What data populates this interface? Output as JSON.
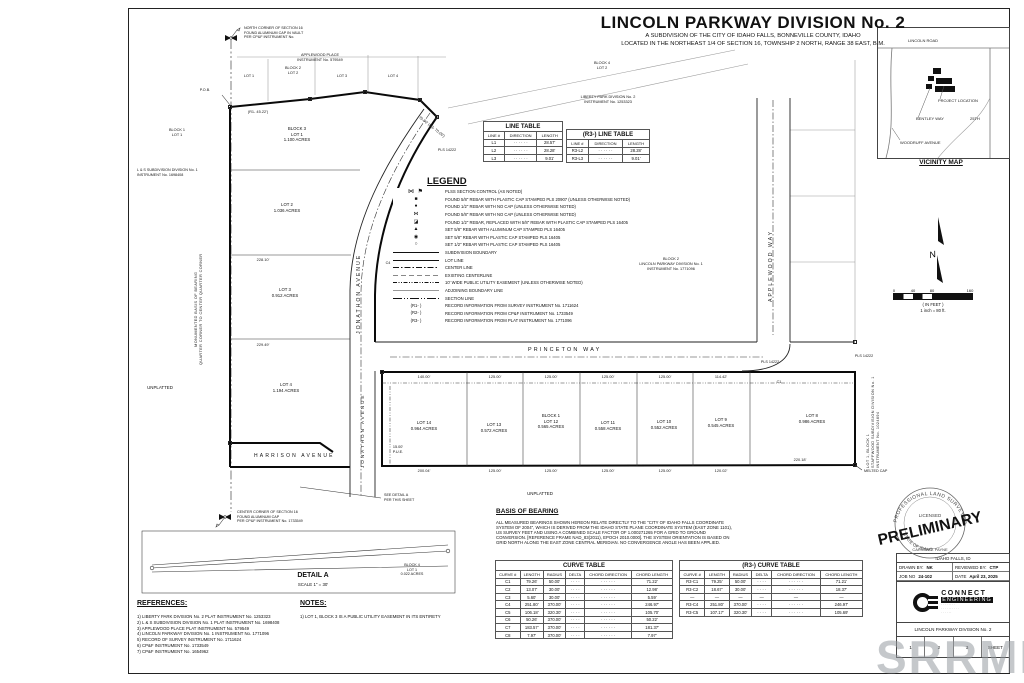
{
  "title": {
    "main": "LINCOLN PARKWAY DIVISION No. 2",
    "sub1": "A SUBDIVISION OF THE CITY OF IDAHO FALLS, BONNEVILLE COUNTY, IDAHO",
    "sub2": "LOCATED IN THE NORTHEAST 1/4 OF SECTION 16, TOWNSHIP 2 NORTH, RANGE 38 EAST, B.M."
  },
  "vicinity": {
    "title": "VICINITY MAP",
    "lincoln": "LINCOLN ROAD",
    "project": "PROJECT LOCATION",
    "bentley": "BENTLEY WAY",
    "t25": "25TH",
    "woodruff": "WOODRUFF AVENUE"
  },
  "north": {
    "label": "N"
  },
  "scalebar": {
    "ticks": [
      "0",
      "40",
      "80",
      "160"
    ],
    "unit": "( IN FEET )",
    "note": "1 inch = 80  ft."
  },
  "corners": {
    "north": [
      "NORTH CORNER OF SECTION 16",
      "FOUND ALUMINUM CAP IN VAULT",
      "PER CP&F INSTRUMENT No."
    ],
    "center": [
      "CENTER CORNER OF SECTION 16",
      "FOUND ALUMINUM CAP",
      "PER CP&F INSTRUMENT No. 1733549"
    ]
  },
  "legend": {
    "title": "LEGEND",
    "items": [
      {
        "sym": "plss",
        "glyph": "⋈ ⚑",
        "text": "PLSS SECTION CONTROL (AS NOTED)"
      },
      {
        "sym": "pt",
        "glyph": "■",
        "text": "FOUND 5/8\" REBAR WITH PLASTIC CAP STAMPED PLS 20907 (UNLESS OTHERWISE NOTED)"
      },
      {
        "sym": "pt",
        "glyph": "●",
        "text": "FOUND 1/2\" REBAR WITH NO CAP (UNLESS OTHERWISE NOTED)"
      },
      {
        "sym": "pt",
        "glyph": "⋈",
        "text": "FOUND 5/8\" REBAR WITH NO CAP (UNLESS OTHERWISE NOTED)"
      },
      {
        "sym": "pt",
        "glyph": "◪",
        "text": "FOUND 1/2\" REBAR, REPLACED WITH 5/8\" REBAR WITH PLASTIC CAP STAMPED PLS 16405"
      },
      {
        "sym": "pt",
        "glyph": "▲",
        "text": "SET 5/8\" REBAR WITH ALUMINUM CAP STAMPED PLS 16405"
      },
      {
        "sym": "pt",
        "glyph": "◉",
        "text": "SET 5/8\" REBAR WITH PLASTIC CAP STAMPED PLS 16405"
      },
      {
        "sym": "pt",
        "glyph": "○",
        "text": "SET 1/2\" REBAR WITH PLASTIC CAP STAMPED PLS 16405"
      },
      {
        "sym": "line-bold",
        "text": "SUBDIVISION BOUNDARY"
      },
      {
        "sym": "line-thin",
        "text": "LOT LINE"
      },
      {
        "sym": "line-dashdot",
        "text": "CENTER LINE"
      },
      {
        "sym": "line-dashed",
        "text": "EXISTING CENTERLINE"
      },
      {
        "sym": "line-pue",
        "text": "10' WIDE PUBLIC UTILITY EASEMENT (UNLESS OTHERWISE NOTED)"
      },
      {
        "sym": "line-adj",
        "text": "ADJOINING BOUNDARY LINE"
      },
      {
        "sym": "line-section",
        "text": "SECTION LINE"
      },
      {
        "sym": "ref",
        "glyph": "(R1- )",
        "text": "RECORD INFORMATION FROM SURVEY INSTRUMENT No. 1711624"
      },
      {
        "sym": "ref",
        "glyph": "(R2- )",
        "text": "RECORD INFORMATION FROM CP&F INSTRUMENT No. 1733549"
      },
      {
        "sym": "ref",
        "glyph": "(R3- )",
        "text": "RECORD INFORMATION FROM PLAT INSTRUMENT No. 1771096"
      }
    ]
  },
  "line_table": {
    "title": "LINE TABLE",
    "columns": [
      "LINE #",
      "DIRECTION",
      "LENGTH"
    ],
    "rows": [
      [
        "L1",
        "· · · · · ·",
        "28.57'"
      ],
      [
        "L2",
        "· · · · · ·",
        "28.28'"
      ],
      [
        "L3",
        "· · · · · ·",
        "9.01'"
      ]
    ]
  },
  "r3_line_table": {
    "title": "(R3-) LINE TABLE",
    "columns": [
      "LINE #",
      "DIRECTION",
      "LENGTH"
    ],
    "rows": [
      [
        "R3-L2",
        "· · · · · ·",
        "28.28'"
      ],
      [
        "R3-L3",
        "· · · · · ·",
        "9.01'"
      ]
    ]
  },
  "curve_table": {
    "title": "CURVE TABLE",
    "columns": [
      "CURVE #",
      "LENGTH",
      "RADIUS",
      "DELTA",
      "CHORD DIRECTION",
      "CHORD LENGTH"
    ],
    "rows": [
      [
        "C1",
        "79.26'",
        "50.00'",
        "· · · ·",
        "· · · · · ·",
        "71.22'"
      ],
      [
        "C2",
        "13.07'",
        "30.00'",
        "· · · ·",
        "· · · · · ·",
        "12.98'"
      ],
      [
        "C3",
        "5.60'",
        "30.00'",
        "· · · ·",
        "· · · · · ·",
        "5.59'"
      ],
      [
        "C4",
        "251.80'",
        "370.00'",
        "· · · ·",
        "· · · · · ·",
        "246.97'"
      ],
      [
        "C5",
        "106.18'",
        "320.30'",
        "· · · ·",
        "· · · · · ·",
        "105.70'"
      ],
      [
        "C6",
        "50.26'",
        "370.00'",
        "· · · ·",
        "· · · · · ·",
        "50.22'"
      ],
      [
        "C7",
        "183.57'",
        "370.00'",
        "· · · ·",
        "· · · · · ·",
        "181.37'"
      ],
      [
        "C8",
        "7.97'",
        "370.00'",
        "· · · ·",
        "· · · · · ·",
        "7.97'"
      ]
    ]
  },
  "r3_curve_table": {
    "title": "(R3-) CURVE TABLE",
    "columns": [
      "CURVE #",
      "LENGTH",
      "RADIUS",
      "DELTA",
      "CHORD DIRECTION",
      "CHORD LENGTH"
    ],
    "rows": [
      [
        "R3-C1",
        "79.25'",
        "50.00'",
        "· · · ·",
        "· · · · · ·",
        "71.21'"
      ],
      [
        "R3-C2",
        "18.67'",
        "30.00'",
        "· · · ·",
        "· · · · · ·",
        "18.37'"
      ],
      [
        "—",
        "—",
        "—",
        "—",
        "—",
        "—"
      ],
      [
        "R3-C4",
        "251.80'",
        "370.00'",
        "· · · ·",
        "· · · · · ·",
        "246.97'"
      ],
      [
        "R3-C5",
        "107.17'",
        "320.30'",
        "· · · ·",
        "· · · · · ·",
        "105.69'"
      ]
    ]
  },
  "basis": {
    "title": "BASIS OF BEARING",
    "lines": [
      "ALL MEASURED BEARINGS SHOWN HEREON RELATE DIRECTLY TO THE \"CITY OF IDAHO FALLS COORDINATE",
      "SYSTEM OF 2004\", WHICH IS DERIVED FROM THE IDAHO STATE PLANE COORDINATE SYSTEM (EAST ZONE 1101),",
      "US SURVEY FEET AND USING A COMBINED SCALE FACTOR OF 1.000271265 FOR A GRID TO GROUND",
      "CONVERSION. [REFERENCE FRAME NAD_83(2011), EPOCH 2010.0000]. THE SYSTEM ORIENTATION IS BASED ON",
      "GRID NORTH ALONG THE EAST ZONE CENTRAL MERIDIAN. NO CONVERGENCE ANGLE HAS BEEN APPLIED."
    ]
  },
  "references": {
    "title": "REFERENCES:",
    "items": [
      "1) LIBERTY PARK DIVISION No. 2 PLAT INSTRUMENT No. 1253323",
      "2) L & S SUBDIVISION DIVISION No. 1 PLAT INSTRUMENT No. 1698408",
      "3) APPLEWOOD PLACE PLAT INSTRUMENT No. 579549",
      "4) LINCOLN PARKWAY DIVISION No. 1 INSTRUMENT No. 1771096",
      "5) RECORD OF SURVEY INSTRUMENT No. 1711624",
      "6) CP&F INSTRUMENT No. 1733549",
      "7) CP&F INSTRUMENT No. 1654962"
    ]
  },
  "notes": {
    "title": "NOTES:",
    "items": [
      "1) LOT 1, BLOCK 3 IS A PUBLIC UTILITY EASEMENT IN ITS ENTIRETY"
    ]
  },
  "detail_a": {
    "title": "DETAIL A",
    "scale": "SCALE 1\" = 30'",
    "lot": [
      "BLOCK 4",
      "LOT 1",
      "0.022 ACRES"
    ],
    "see": [
      "SEE DETAIL A",
      "PER THIS SHEET"
    ]
  },
  "plat": {
    "streets": {
      "princeton": "PRINCETON WAY",
      "jonathon": "JONATHON AVENUE",
      "applewood": "APPLEWOOD WAY",
      "harrison": "HARRISON AVENUE"
    },
    "lots": {
      "block3": [
        [
          "BLOCK 3",
          "LOT 1",
          "1.100 ACRES"
        ],
        [
          "LOT 2",
          "1.036 ACRES"
        ],
        [
          "LOT 3",
          "0.912 ACRES"
        ],
        [
          "LOT 4",
          "1.194 ACRES"
        ]
      ],
      "block1": [
        [
          "LOT 14",
          "0.964 ACRES"
        ],
        [
          "LOT 13",
          "0.572 ACRES"
        ],
        [
          "BLOCK 1",
          "LOT 12",
          "0.565 ACRES"
        ],
        [
          "LOT 11",
          "0.558 ACRES"
        ],
        [
          "LOT 10",
          "0.552 ACRES"
        ],
        [
          "LOT 9",
          "0.545 ACRES"
        ],
        [
          "LOT 8",
          "0.986 ACRES"
        ]
      ]
    },
    "adjoining": {
      "applewood_place": [
        "APPLEWOOD PLACE",
        "INSTRUMENT No. 579549"
      ],
      "ap_lot1": "LOT 1",
      "ap_block2": [
        "BLOCK 2",
        "LOT 2"
      ],
      "ap_lot3": "LOT 3",
      "ap_lot4": "LOT 4",
      "liberty": [
        "LIBERTY PARK DIVISION No. 2",
        "INSTRUMENT No. 1253323"
      ],
      "liberty_block4": [
        "BLOCK 4",
        "LOT 2"
      ],
      "ls": [
        "L & S SUBDIVISION DIVISION No. 1",
        "INSTRUMENT No. 1698408"
      ],
      "ls_block1": [
        "BLOCK 1",
        "LOT 1"
      ],
      "div1": [
        "BLOCK 2",
        "LINCOLN PARKWAY DIVISION No. 1",
        "INSTRUMENT No. 1771096"
      ],
      "staffwood": [
        "LOT 1, BLOCK 1",
        "STAFFWOOD SUBDIVISION DIVISION No. 1",
        "INSTRUMENT No. 1024694"
      ],
      "unplatted": "UNPLATTED",
      "melted": "MELTED CAP",
      "pls": "PLS 14222",
      "pob": "P.O.B.",
      "c1": "C1",
      "c4": "C4",
      "monumented": [
        "MONUMENTED BASIS OF BEARING",
        "QUARTER CORNER TO CENTER QUARTER CORNER"
      ]
    },
    "dims": {
      "d140": "140.00'",
      "d125": "125.00'",
      "d114": "114.42'",
      "d200": "200.04'",
      "d120": "120.02'",
      "d220": "220.18'",
      "d228": "228.10'",
      "d229": "229.49'",
      "r1": "(R1- 45.22')",
      "r3": "70.00' (R3- 70.00')"
    },
    "pue": [
      "15.00'",
      "P.U.E."
    ]
  },
  "stamp": {
    "word": "PRELIMINARY",
    "seal_top": "PROFESSIONAL LAND SURVEYOR",
    "seal_mid": "LICENSED",
    "seal_bottom": "STATE OF IDAHO",
    "seal_name": "CARSON T. PAYNE"
  },
  "titleblock": {
    "city": "IDAHO FALLS, ID",
    "drawn_label": "DRAWN BY:",
    "drawn": "NK",
    "reviewed_label": "REVIEWED BY:",
    "reviewed": "CTP",
    "job_label": "JOB NO",
    "job": "24-102",
    "date_label": "DATE",
    "date": "April 23, 2025",
    "firm_name": "CONNECT",
    "firm_name2": "ENGINEERING",
    "firm_lines": [
      "· · · · · · · ·",
      "· · · · · · · · · ·",
      "· · · · · ·"
    ],
    "project": "LINCOLN PARKWAY DIVISION No. 2",
    "sheet_cells": [
      "1",
      "2",
      "3",
      "SHEET"
    ]
  },
  "watermark": {
    "text": "SRRMLS"
  },
  "colors": {
    "ink": "#111111",
    "light_line": "#9a9a9a",
    "watermark": "#969aa0"
  }
}
